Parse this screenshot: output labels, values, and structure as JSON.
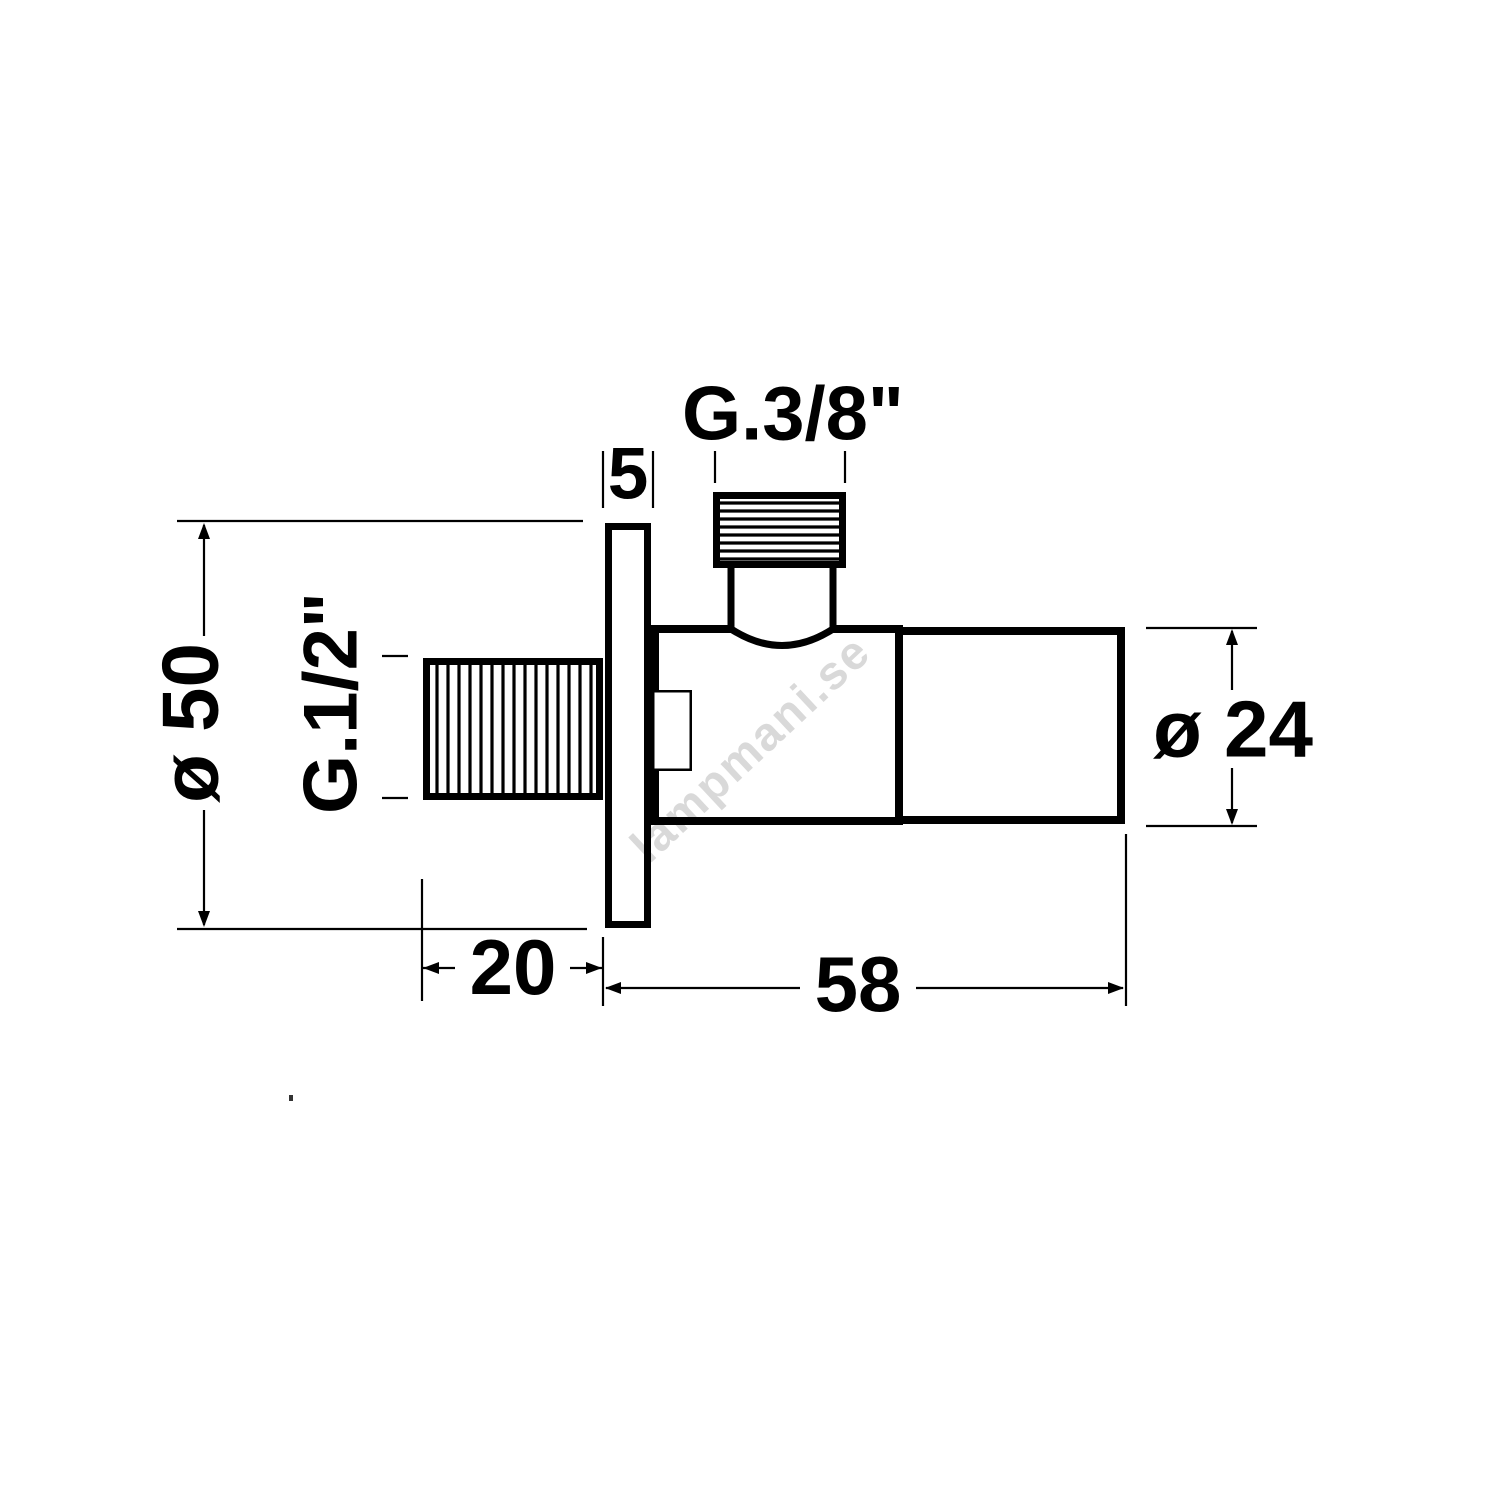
{
  "drawing": {
    "background": "#ffffff",
    "line_color": "#000000",
    "labels": {
      "flange_diameter": "ø 50",
      "side_thread": "G.1/2\"",
      "flange_thickness": "5",
      "top_thread": "G.3/8\"",
      "thread_length": "20",
      "body_length": "58",
      "body_diameter": "ø 24"
    },
    "watermark": {
      "text": "lampmani.se",
      "color": "#d9d9d9"
    }
  }
}
